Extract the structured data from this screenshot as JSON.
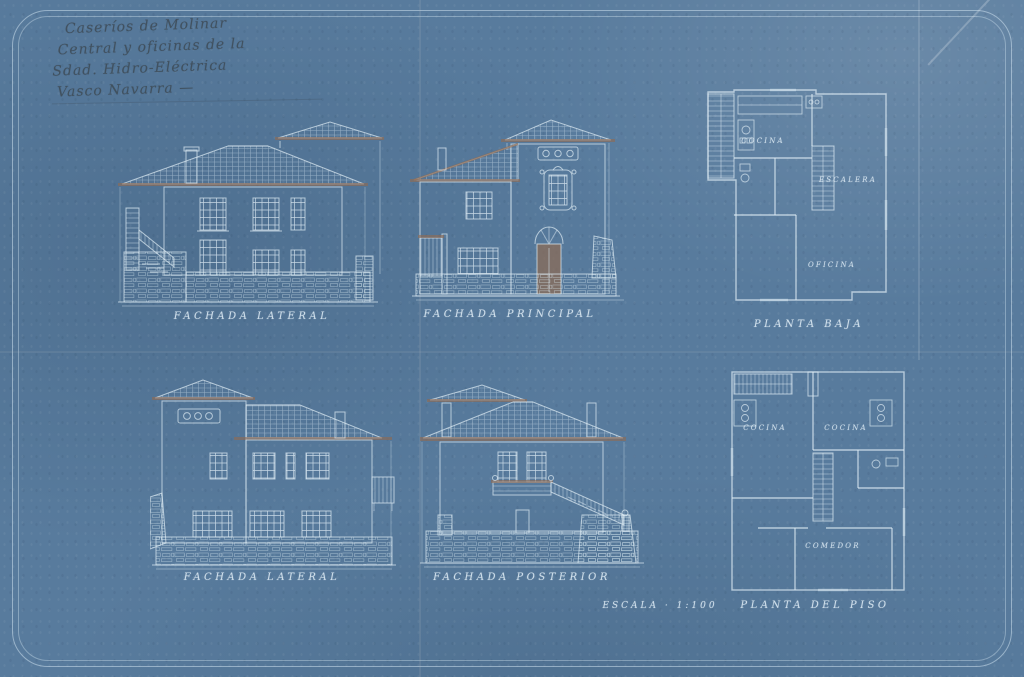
{
  "colors": {
    "paper": "#587b9d",
    "line": "#dceaf3",
    "sepia": "#8f6b52",
    "handwriting": "#3c4852",
    "caption": "rgba(226,239,248,0.8)"
  },
  "annotation": {
    "line1": "Caseríos de Molinar",
    "line2": "Central y oficinas de la",
    "line3": "Sdad. Hidro-Eléctrica",
    "line4": "Vasco Navarra —"
  },
  "drawings": {
    "fachada_lateral_1": {
      "caption": "FACHADA LATERAL"
    },
    "fachada_principal": {
      "caption": "FACHADA PRINCIPAL"
    },
    "planta_baja": {
      "caption": "PLANTA BAJA",
      "rooms": {
        "cocina": "COCINA",
        "escalera": "ESCALERA",
        "oficina": "OFICINA"
      }
    },
    "fachada_lateral_2": {
      "caption": "FACHADA LATERAL"
    },
    "fachada_posterior": {
      "caption": "FACHADA POSTERIOR"
    },
    "planta_piso": {
      "caption": "PLANTA DEL PISO",
      "rooms": {
        "cocina_izq": "COCINA",
        "cocina_der": "COCINA",
        "comedor": "COMEDOR"
      }
    },
    "escala": "ESCALA · 1:100"
  }
}
